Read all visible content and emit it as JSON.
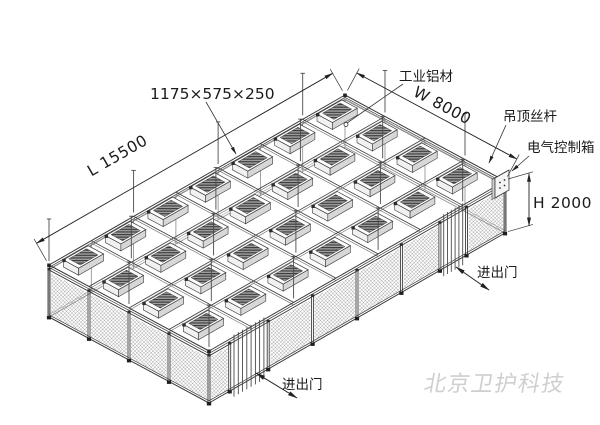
{
  "dimensions": {
    "length": "L 15500",
    "width": "W 8000",
    "height": "H 2000"
  },
  "labels": {
    "ffu_size": "1175×575×250",
    "material": "工业铝材",
    "ceiling_rod": "吊顶丝杆",
    "control_box": "电气控制箱",
    "doors": [
      "进出门",
      "进出门"
    ]
  },
  "watermark": "北京卫护科技",
  "colors": {
    "line": "#3a3a3a",
    "line_light": "#8a8a8a",
    "mesh": "#969696",
    "text": "#1b1b1b",
    "watermark": "#cfcfcf",
    "background": "#ffffff"
  }
}
